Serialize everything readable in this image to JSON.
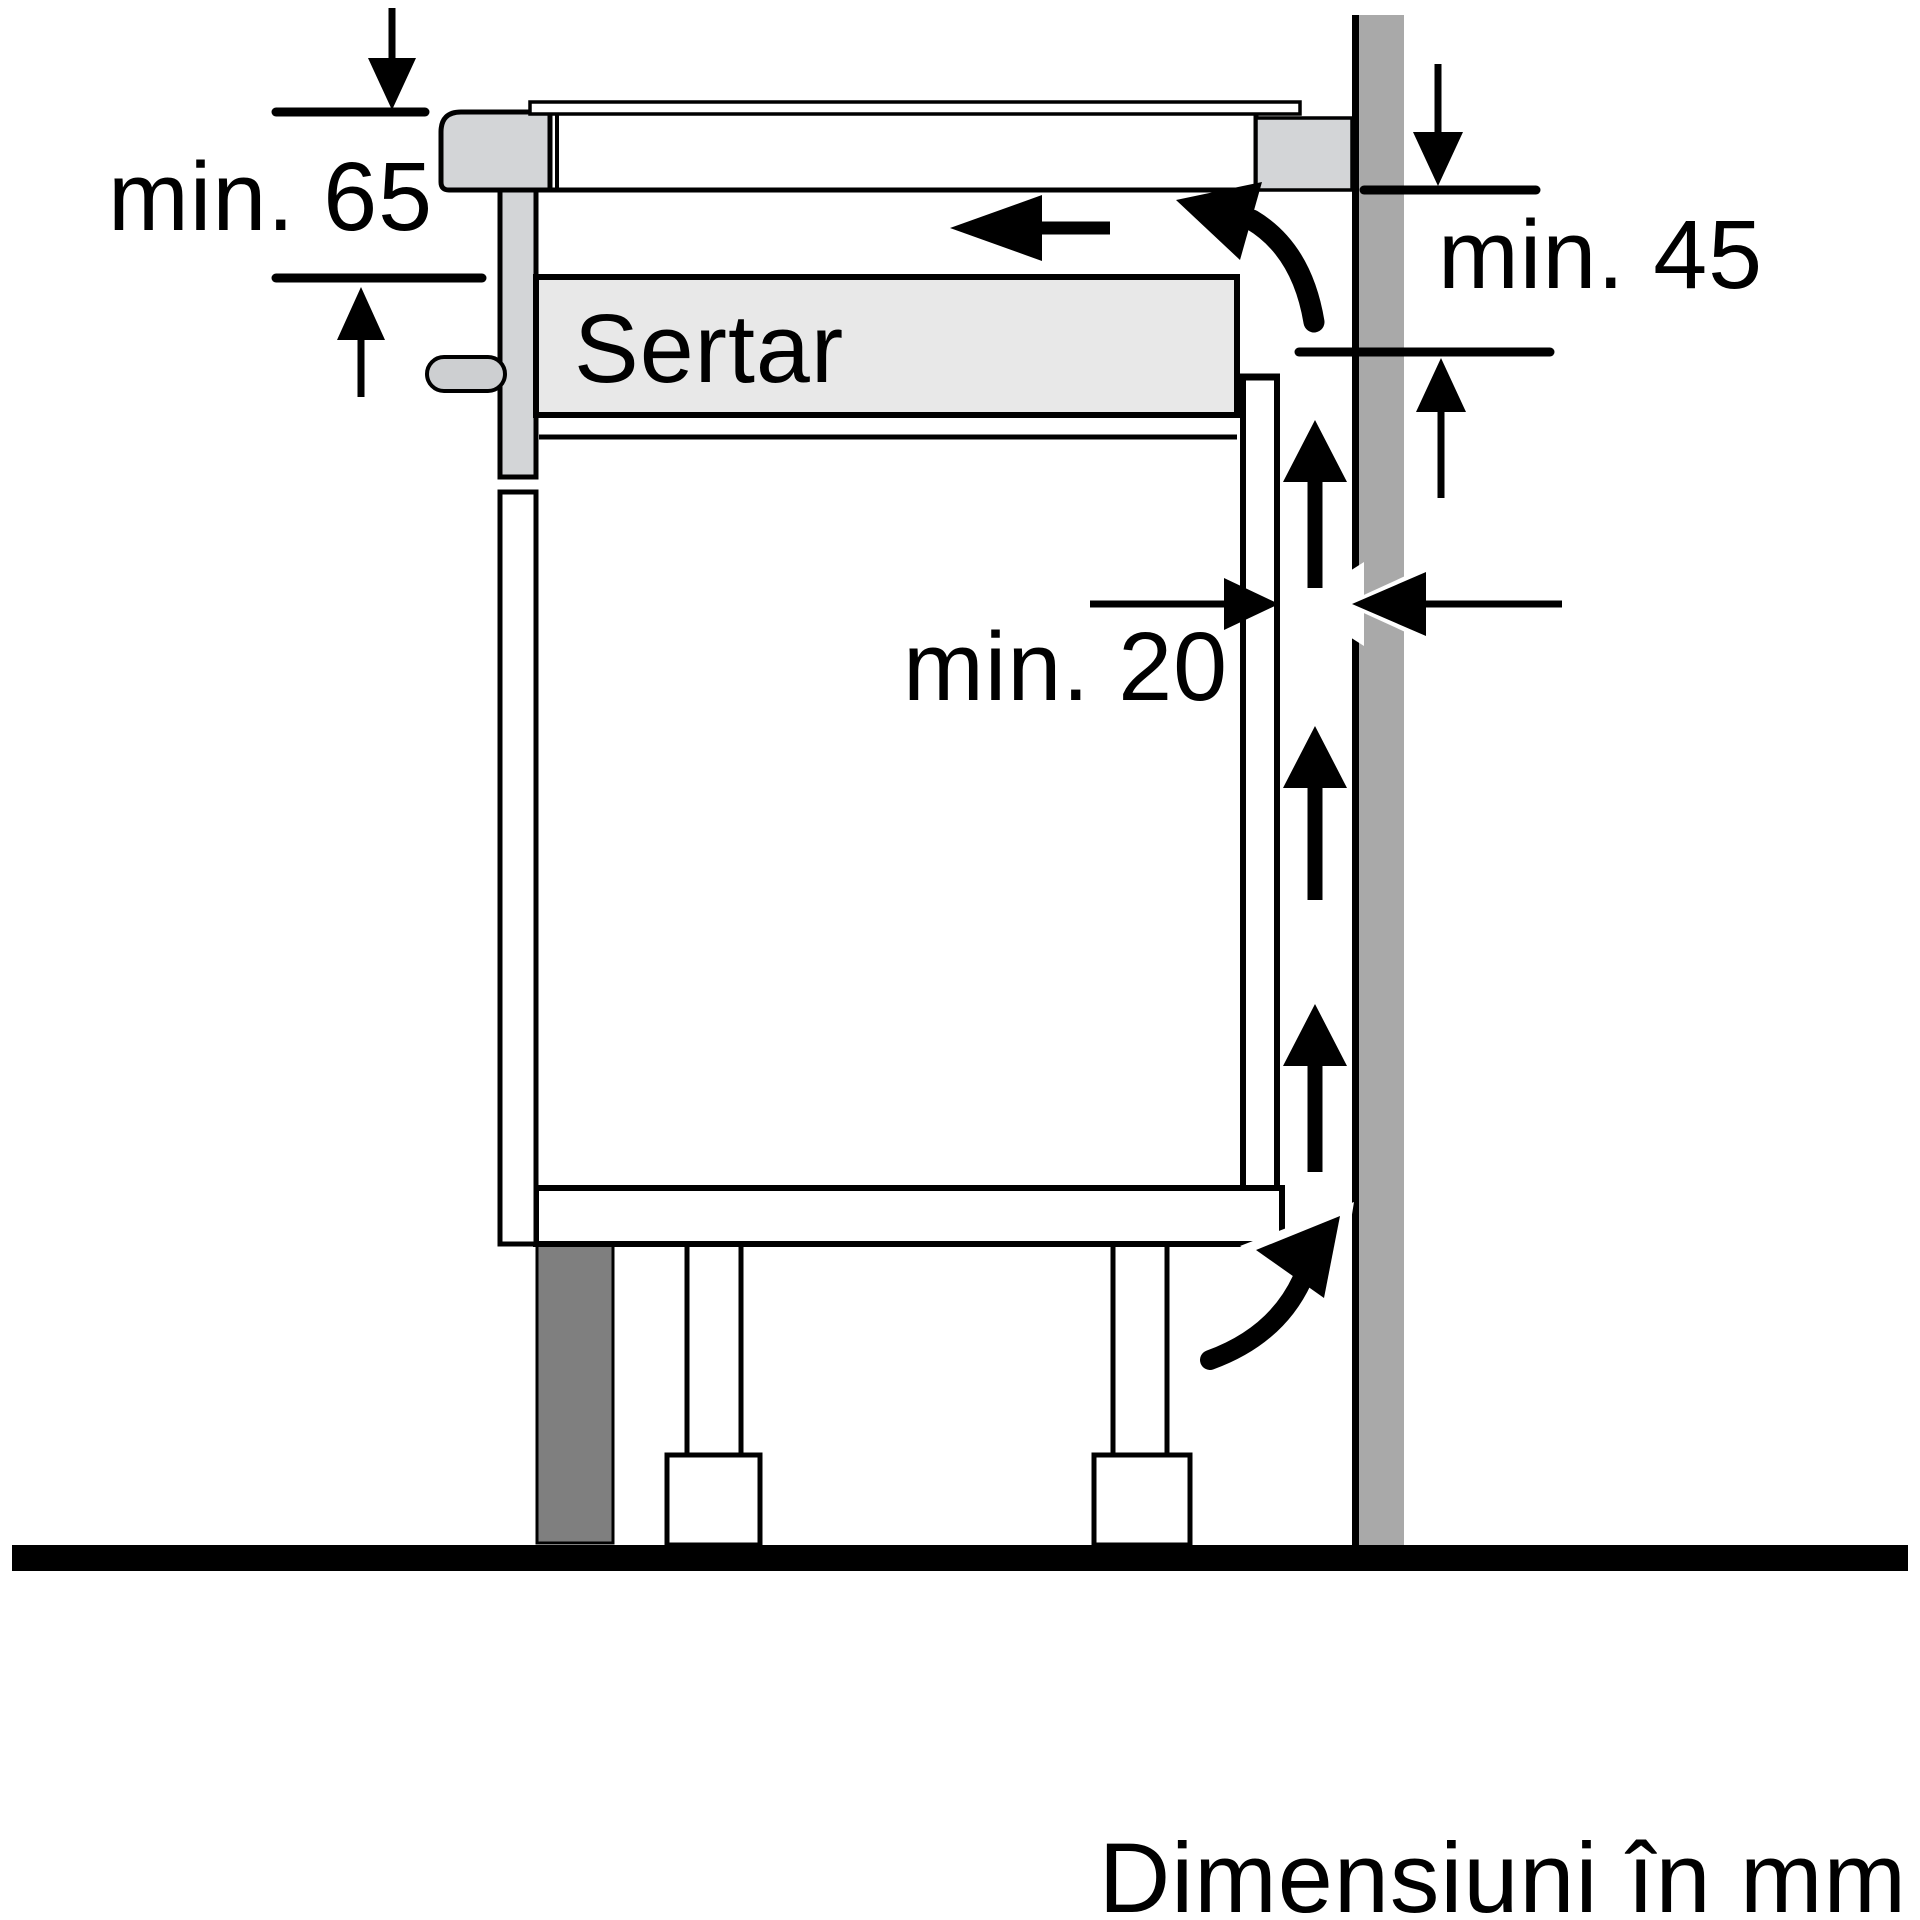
{
  "diagram": {
    "type": "appliance-installation-drawing",
    "caption": "Dimensiuni în mm",
    "drawer_label": "Sertar",
    "dimensions": {
      "hob_depth": {
        "label": "min. 65",
        "value": 65,
        "unit": "mm"
      },
      "vent_side": {
        "label": "min. 45",
        "value": 45,
        "unit": "mm"
      },
      "rear_gap": {
        "label": "min. 20",
        "value": 20,
        "unit": "mm"
      }
    }
  },
  "colors": {
    "background": "#ffffff",
    "line": "#000000",
    "wall": "#a9a9a9",
    "panel_light": "#d3d5d7",
    "drawer_fill": "#e8e8e8",
    "handle": "#cdcfd1",
    "plinth": "#7f7f7f"
  }
}
